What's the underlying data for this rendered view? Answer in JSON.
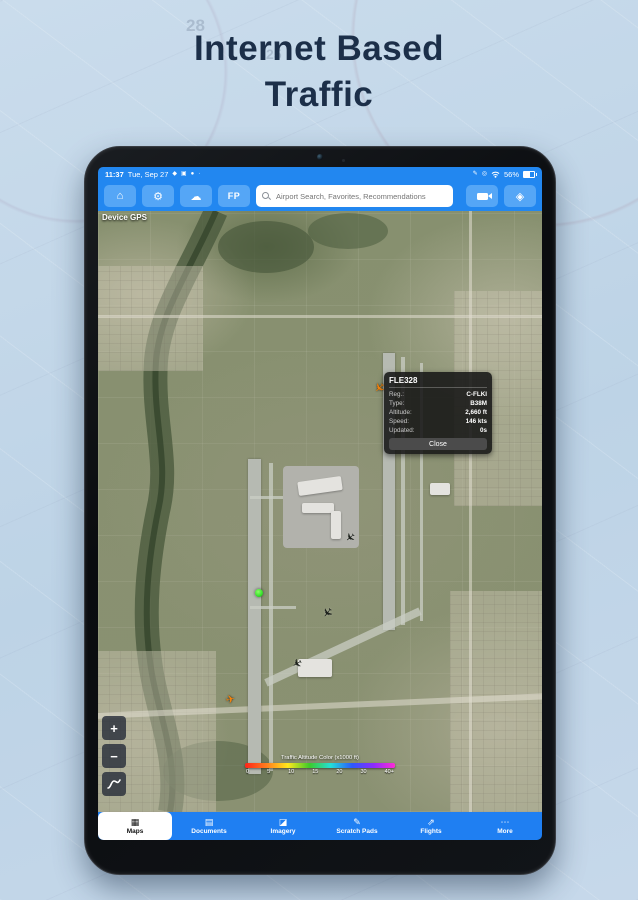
{
  "page": {
    "title_line1": "Internet Based",
    "title_line2": "Traffic",
    "chart_labels": [
      "28",
      "25"
    ]
  },
  "icons": {
    "home": "⌂",
    "settings": "⚙",
    "weather": "☁",
    "location_diamond": "◈",
    "notif_1": "◆",
    "notif_2": "▣",
    "notif_3": "●",
    "notif_more": "·",
    "stylus": "✎",
    "gps_pin": "◎",
    "zoom_in": "+",
    "zoom_out": "−",
    "aircraft": "✈",
    "tab_maps": "▦",
    "tab_documents": "▤",
    "tab_imagery": "◪",
    "tab_scratch": "✎",
    "tab_flights": "⇗",
    "tab_more": "⋯"
  },
  "tablet": {
    "status_bar": {
      "time": "11:37",
      "date": "Tue, Sep 27",
      "battery_percent": "56%"
    },
    "toolbar": {
      "fp_button": "FP",
      "search_placeholder": "Airport Search, Favorites, Recommendations"
    },
    "map": {
      "gps_source_label": "Device GPS",
      "traffic_popup": {
        "callsign": "FLE328",
        "rows": [
          {
            "label": "Reg.:",
            "value": "C-FLKI"
          },
          {
            "label": "Type:",
            "value": "B38M"
          },
          {
            "label": "Altitude:",
            "value": "2,660 ft"
          },
          {
            "label": "Speed:",
            "value": "146 kts"
          },
          {
            "label": "Updated:",
            "value": "0s"
          }
        ],
        "close_button": "Close"
      },
      "altitude_legend": {
        "title": "Traffic Altitude Color (x1000 ft)",
        "ticks": [
          "0",
          "5",
          "10",
          "15",
          "20",
          "30",
          "40+"
        ],
        "gradient_colors": [
          "#ff2419",
          "#ff7d1e",
          "#ffe81c",
          "#3ecb28",
          "#23dfd8",
          "#2b59ff",
          "#8c2bff",
          "#ff2bd6"
        ]
      }
    },
    "tab_bar": {
      "active_tab": "Maps",
      "tabs": [
        {
          "label": "Maps"
        },
        {
          "label": "Documents"
        },
        {
          "label": "Imagery"
        },
        {
          "label": "Scratch Pads"
        },
        {
          "label": "Flights"
        },
        {
          "label": "More"
        }
      ]
    }
  },
  "colors": {
    "page_bg": "#c3d7e9",
    "title_text": "#1c2f49",
    "bar_blue": "#2287f0",
    "button_blue": "#55a6f6",
    "tab_blue": "#1f7ff2",
    "traffic_orange": "#f5820a",
    "traffic_green": "#35e02a",
    "popup_bg": "rgba(22,22,22,0.88)"
  }
}
